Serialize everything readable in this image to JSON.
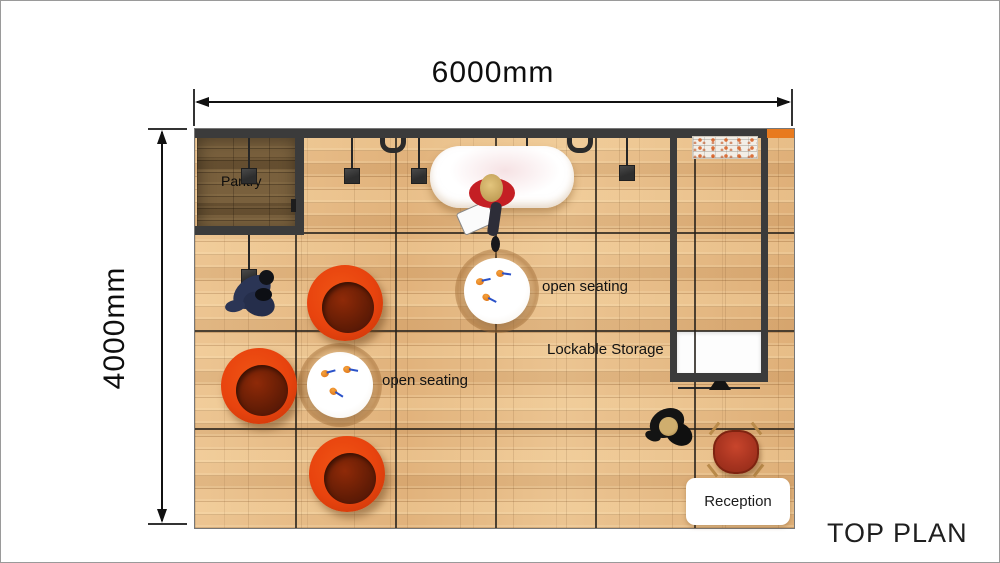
{
  "title": "TOP PLAN",
  "dimensions": {
    "width": "6000mm",
    "height": "4000mm"
  },
  "labels": {
    "pantry": "Pantry",
    "open_seating_center": "open seating",
    "open_seating_left": "open seating",
    "lockable_storage": "Lockable Storage",
    "reception": "Reception"
  },
  "colors": {
    "wall": "#3b3b3b",
    "floor_wood": "#e6b983",
    "pantry_wood": "#79603d",
    "lounge_chair_orange": "#e8430e",
    "reception_chair_red": "#a83420",
    "accent_wall_orange": "#e87a1e",
    "counter_white": "#ffffff",
    "dimension_line": "#111111"
  }
}
